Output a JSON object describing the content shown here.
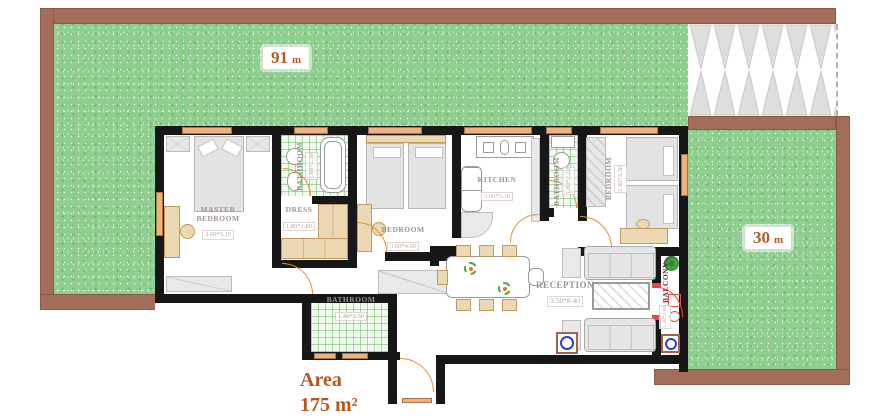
{
  "gardens": {
    "front": {
      "value": "91",
      "unit": "m"
    },
    "side": {
      "value": "30",
      "unit": "m"
    }
  },
  "area_label": {
    "word": "Area",
    "value": "175 m²"
  },
  "rooms": {
    "master": {
      "name": "Master Bedroom",
      "dim": "3.60*5.20"
    },
    "dress": {
      "name": "Dress",
      "dim": "1.80*1.80"
    },
    "bath1": {
      "name": "Bathroom",
      "dim": "1.60*2.50"
    },
    "bed2": {
      "name": "Bedroom",
      "dim": "3.60*4.00"
    },
    "kitchen": {
      "name": "Kitchen",
      "dim": "3.00*3.30"
    },
    "bath2": {
      "name": "Bathroom",
      "dim": "1.60*2.20"
    },
    "bed3": {
      "name": "Bedroom",
      "dim": "3.40*3.30"
    },
    "reception": {
      "name": "Reception",
      "dim": "3.50*8.40"
    },
    "bath3": {
      "name": "Bathroom",
      "dim": "1.40*2.50"
    },
    "balcony": {
      "name": "Balcony",
      "dim": "1.20*3.00"
    }
  },
  "colors": {
    "grass": "#8fce8f",
    "fence_brown": "#a26e59",
    "wall_black": "#171717",
    "door_orange": "#e2902f",
    "balcony_red": "#e04848",
    "appliance_blue": "#2b3fd6",
    "label_orange": "#b3591f"
  }
}
